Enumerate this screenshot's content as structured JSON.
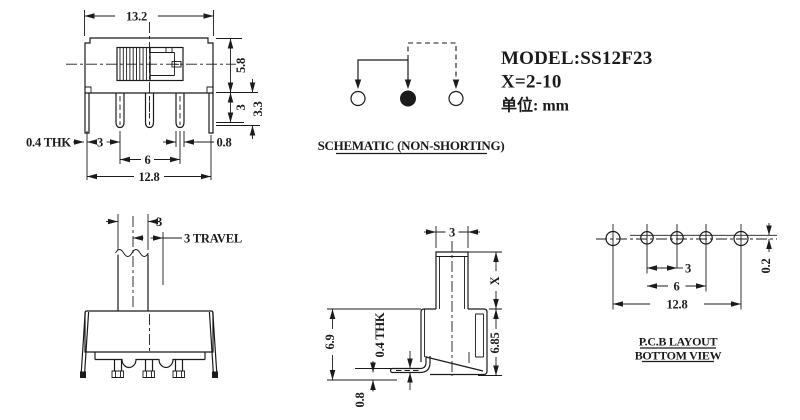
{
  "colors": {
    "line": "#1b1b1b",
    "background": "#ffffff"
  },
  "title_block": {
    "model": "MODEL:SS12F23",
    "x_spec": "X=2-10",
    "unit": "单位: mm"
  },
  "schematic": {
    "caption": "SCHEMATIC (NON-SHORTING)"
  },
  "front_view": {
    "dims": {
      "top_width": "13.2",
      "body_height": "5.8",
      "pin_length": "3",
      "leg_length": "3.3",
      "thickness": "0.4 THK",
      "leg_to_pin": "3",
      "pin_span": "6",
      "pin_width": "0.8",
      "leg_span": "12.8"
    }
  },
  "side_view": {
    "dims": {
      "knob_width": "3",
      "travel": "3 TRAVEL"
    }
  },
  "profile_view": {
    "dims": {
      "knob_width": "3",
      "actuator_height": "X",
      "body_height": "6.85",
      "total_height": "6.9",
      "pin_thickness": "0.4 THK",
      "standoff": "0.8"
    }
  },
  "pcb_layout": {
    "caption_line1": "P.C.B LAYOUT",
    "caption_line2": "BOTTOM VIEW",
    "dims": {
      "pitch": "3",
      "span": "6",
      "width": "12.8",
      "row_offset": "0.2"
    }
  }
}
